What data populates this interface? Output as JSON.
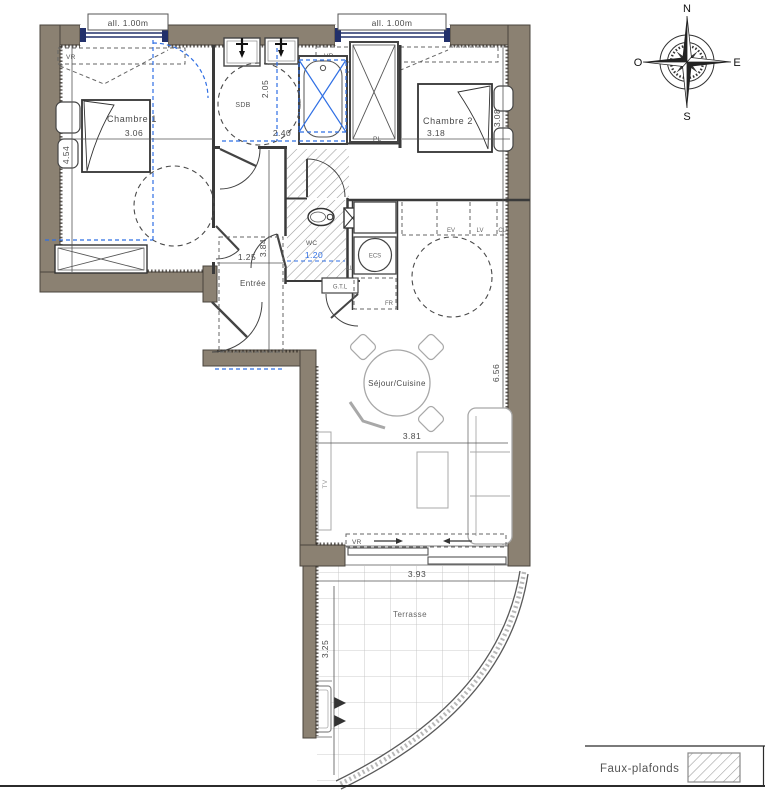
{
  "colors": {
    "wall": "#8b8172",
    "accent_blue": "#2f6fe4",
    "line_dark": "#3c3c3c",
    "window_navy": "#22306b",
    "hatch_gray": "#9a9a9a",
    "furniture_gray": "#a8a8a8"
  },
  "windows": {
    "allege_label": "all. 1.00m",
    "shutter_label": "VR"
  },
  "rooms": {
    "chambre1": {
      "label": "Chambre 1",
      "width_m": "3.06",
      "depth_m": "4.54"
    },
    "chambre2": {
      "label": "Chambre 2",
      "width_m": "3.18",
      "depth_m": "3.08"
    },
    "sdb": {
      "label": "SDB",
      "width_m": "2.40",
      "depth_m": "2.05"
    },
    "wc": {
      "label": "WC",
      "clear_width_m": "1.20"
    },
    "entree": {
      "label": "Entrée",
      "width_m": "1.25",
      "depth_m": "3.84"
    },
    "sejour": {
      "label": "Séjour/Cuisine",
      "width_m": "3.81",
      "depth_m": "6.56"
    },
    "terrasse": {
      "label": "Terrasse",
      "width_m": "3.93",
      "depth_m": "3.25"
    }
  },
  "equipment": {
    "closet": "PL",
    "water_heater": "ECS",
    "fridge": "FR",
    "technical_box": "G.T.L",
    "sink": "EV",
    "dishwasher": "LV",
    "cooktop": "CU",
    "washer": "LL",
    "tv": "TV"
  },
  "compass": {
    "north": "N",
    "south": "S",
    "east": "E",
    "west": "O"
  },
  "legend": {
    "false_ceiling": "Faux-plafonds"
  }
}
